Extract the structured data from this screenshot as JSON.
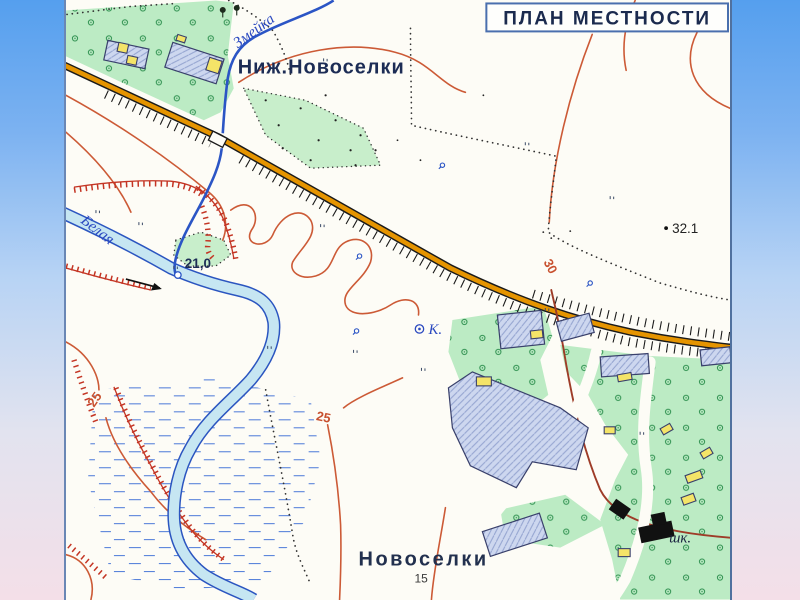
{
  "title": "ПЛАН МЕСТНОСТИ",
  "map": {
    "settlements": {
      "upper": "Ниж.Новоселки",
      "lower": "Новоселки",
      "lower_house_count": "15"
    },
    "rivers": {
      "main": "Белая",
      "tributary": "Змейка"
    },
    "poi": {
      "school_abbrev": "шк.",
      "well_abbrev": "К."
    },
    "elevations": {
      "water_edge_mark": "21,0",
      "spot_height": "32.1"
    },
    "contour_labels": {
      "left_25": "25",
      "center_25": "25",
      "right_30": "30"
    },
    "colors": {
      "background_top": "#559fee",
      "background_bottom": "#f4dfe8",
      "paper": "#fdfcf6",
      "water_line": "#2b55c5",
      "water_fill": "#c6e6f2",
      "road_fill": "#e59400",
      "road_casing": "#1a1a1a",
      "contour": "#cc5a36",
      "cliff": "#c43524",
      "vegetation": "#bcebc4",
      "block_hatched": "#cdd7ef",
      "building_yellow": "#f4e468",
      "building_dark": "#111111",
      "label_navy": "#1c2c55",
      "track": "#9e3c28"
    }
  }
}
